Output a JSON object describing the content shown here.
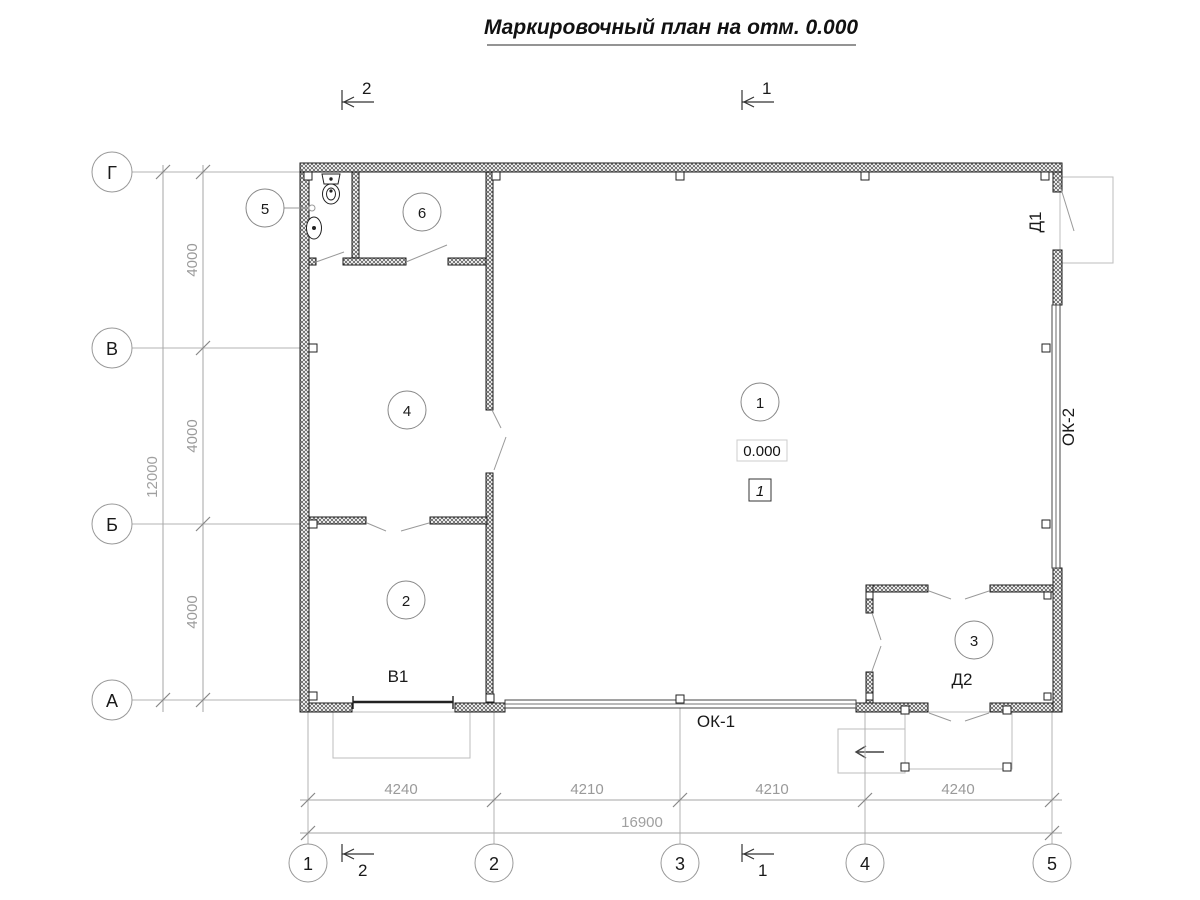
{
  "title": "Маркировочный план на отм. 0.000",
  "axes": {
    "rows": [
      "Г",
      "В",
      "Б",
      "А"
    ],
    "cols": [
      "1",
      "2",
      "3",
      "4",
      "5"
    ]
  },
  "dimensions": {
    "left_segments": [
      "4000",
      "4000",
      "4000"
    ],
    "left_total": "12000",
    "bottom_segments": [
      "4240",
      "4210",
      "4210",
      "4240"
    ],
    "bottom_total": "16900"
  },
  "rooms": [
    "1",
    "2",
    "3",
    "4",
    "5",
    "6"
  ],
  "marks": {
    "gate": "В1",
    "window_main": "ОК-1",
    "window_side": "ОК-2",
    "door_side": "Д1",
    "door_entry": "Д2"
  },
  "elevation": {
    "value": "0.000",
    "zone_number": "1"
  },
  "section_marks": {
    "top_left": "2",
    "top_right": "1",
    "bottom_left": "2",
    "bottom_right": "1"
  }
}
